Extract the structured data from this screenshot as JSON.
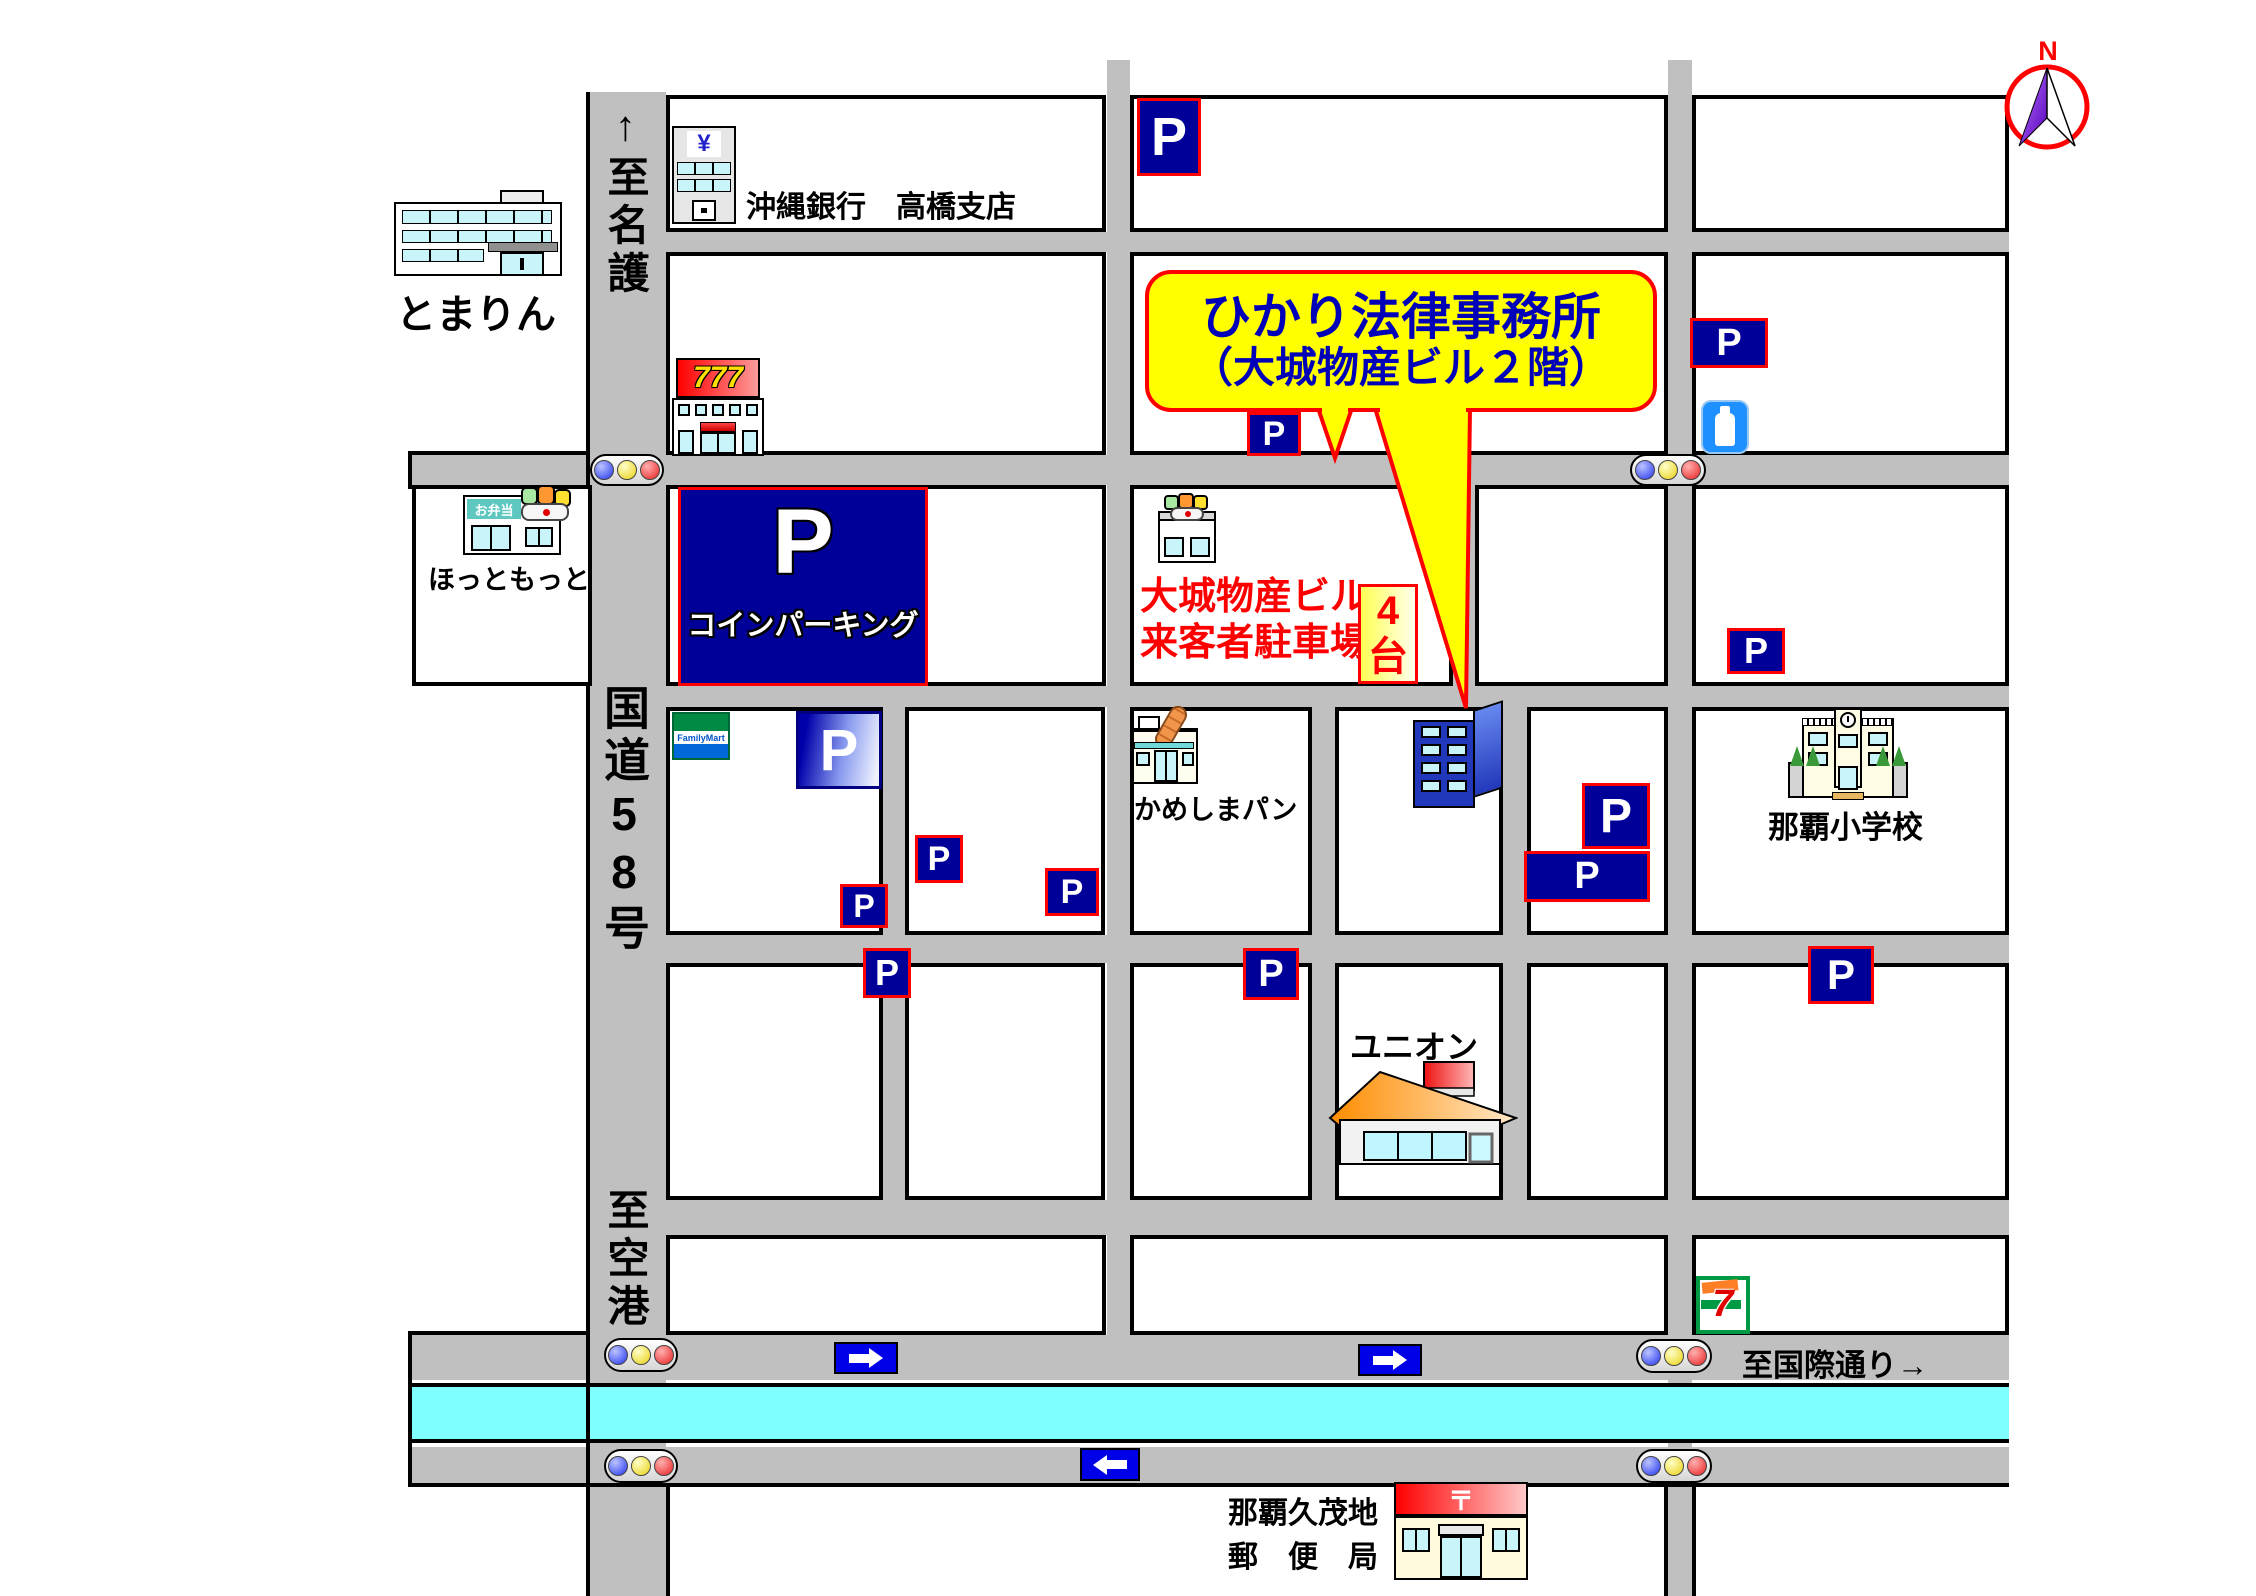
{
  "compass": {
    "north": "N"
  },
  "roads": {
    "to_nago": "↑至名護",
    "route58": "国道58号",
    "to_airport": "至空港↓",
    "to_kokusai": "至国際通り→"
  },
  "parking": {
    "letter": "P",
    "coin_label": "コインパーキング"
  },
  "office_callout": {
    "line1": "ひかり法律事務所",
    "line2": "（大城物産ビル２階）"
  },
  "visitor_parking": {
    "line1": "大城物産ビル",
    "line2": "来客者駐車場",
    "count": "4",
    "unit": "台"
  },
  "landmarks": {
    "tomarin": "とまりん",
    "bank": "沖縄銀行　高橋支店",
    "bank_logo": "¥",
    "pachinko": "777",
    "hottomotto": "ほっともっと",
    "hottomotto_sign": "お弁当",
    "familymart": "FamilyMart",
    "kameshima": "かめしまパン",
    "school": "那覇小学校",
    "union": "ユニオン",
    "seven_eleven": "7",
    "post_office_line1": "那覇久茂地",
    "post_office_line2": "郵　便　局",
    "post_mark": "〒"
  },
  "colors": {
    "road": "#C0C0C0",
    "river": "#7FFFFF",
    "parking_sign": "#000099",
    "callout_bg": "#FFFF00",
    "callout_border": "#FF0000",
    "callout_text": "#0000B8",
    "visitor_text": "#FF0000",
    "arrow_sign": "#0000E8"
  }
}
